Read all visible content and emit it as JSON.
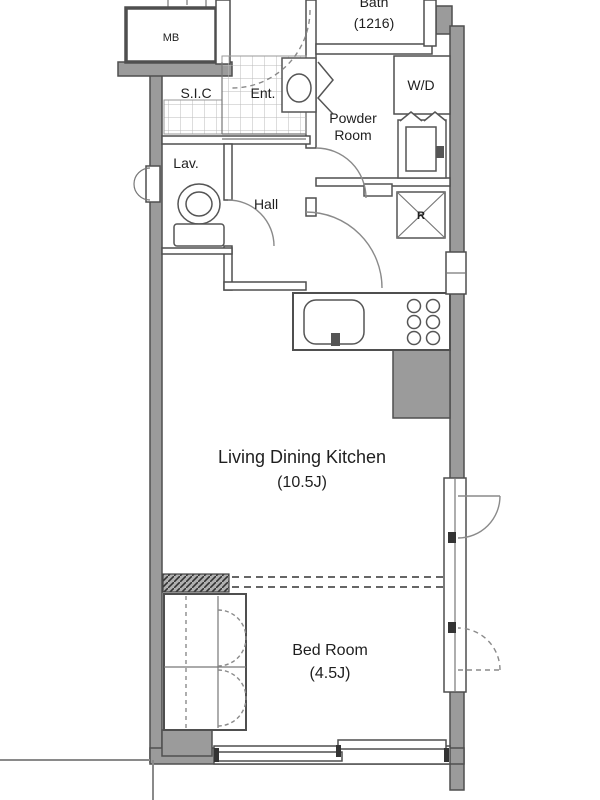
{
  "document": {
    "type": "apartment-floor-plan"
  },
  "labels": {
    "meter_box": "MB",
    "bath_name": "Bath",
    "bath_size": "(1216)",
    "shoe_closet": "S.I.C",
    "entrance": "Ent.",
    "washer_dryer": "W/D",
    "powder_room_line1": "Powder",
    "powder_room_line2": "Room",
    "lavatory": "Lav.",
    "hall": "Hall",
    "refrigerator": "R",
    "ldk_name": "Living Dining Kitchen",
    "ldk_size": "(10.5J)",
    "bedroom_name": "Bed Room",
    "bedroom_size": "(4.5J)"
  },
  "colors": {
    "background": "#ffffff",
    "wall_fill": "#9b9b9b",
    "wall_outline": "#4f4f4f",
    "fixture_line": "#555555",
    "door_line": "#8a8a8a",
    "text": "#1f1f1f"
  }
}
